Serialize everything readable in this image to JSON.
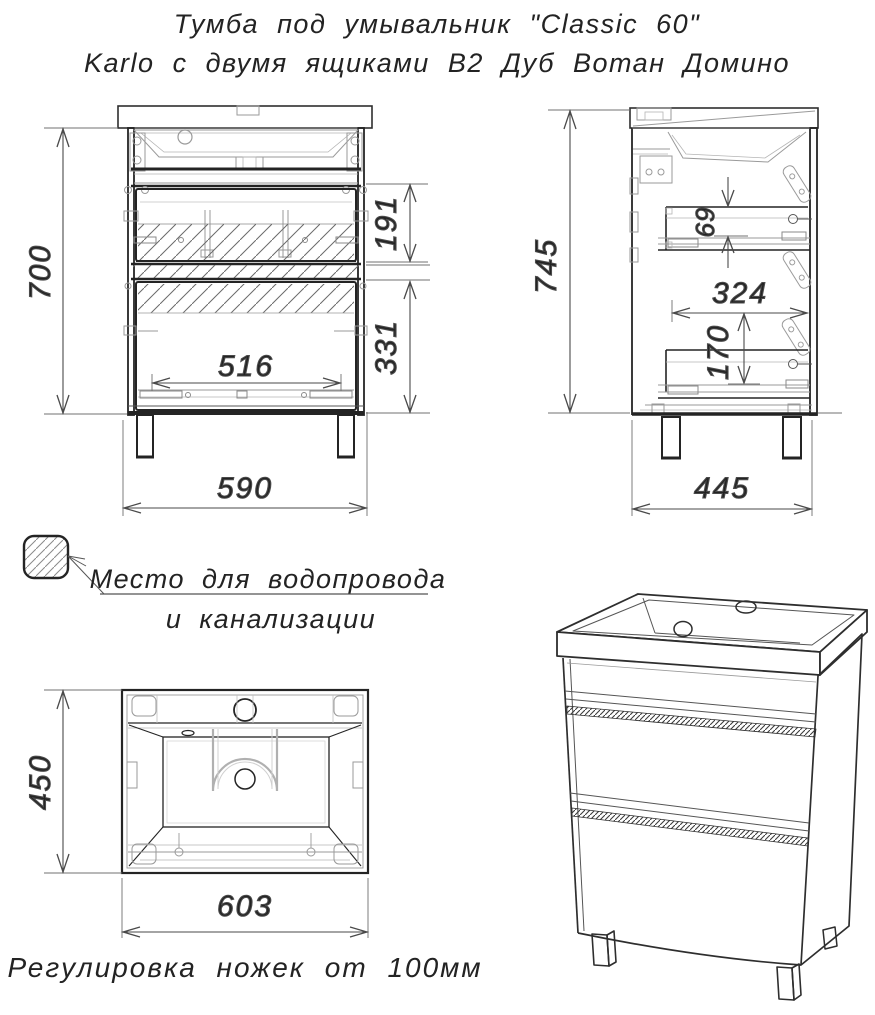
{
  "title": {
    "line1": "Тумба под умывальник \"Classic 60\"",
    "line2": "Karlo с двумя ящиками В2 Дуб Вотан Домино"
  },
  "front": {
    "height": "700",
    "drawer1": "191",
    "drawer2": "331",
    "inner_width": "516",
    "width": "590"
  },
  "side": {
    "height": "745",
    "gap": "69",
    "inner_depth": "324",
    "drawer_height": "170",
    "depth": "445"
  },
  "top": {
    "depth": "450",
    "width": "603"
  },
  "legend": {
    "line1": "Место для водопровода",
    "line2": "и канализации"
  },
  "footnote": {
    "text": "Регулировка ножек от 100мм"
  },
  "colors": {
    "ink": "#2a2a2a",
    "medium": "#555555",
    "light": "#9a9a9a",
    "hatch": "#6a6a6a",
    "bg": "#ffffff"
  }
}
